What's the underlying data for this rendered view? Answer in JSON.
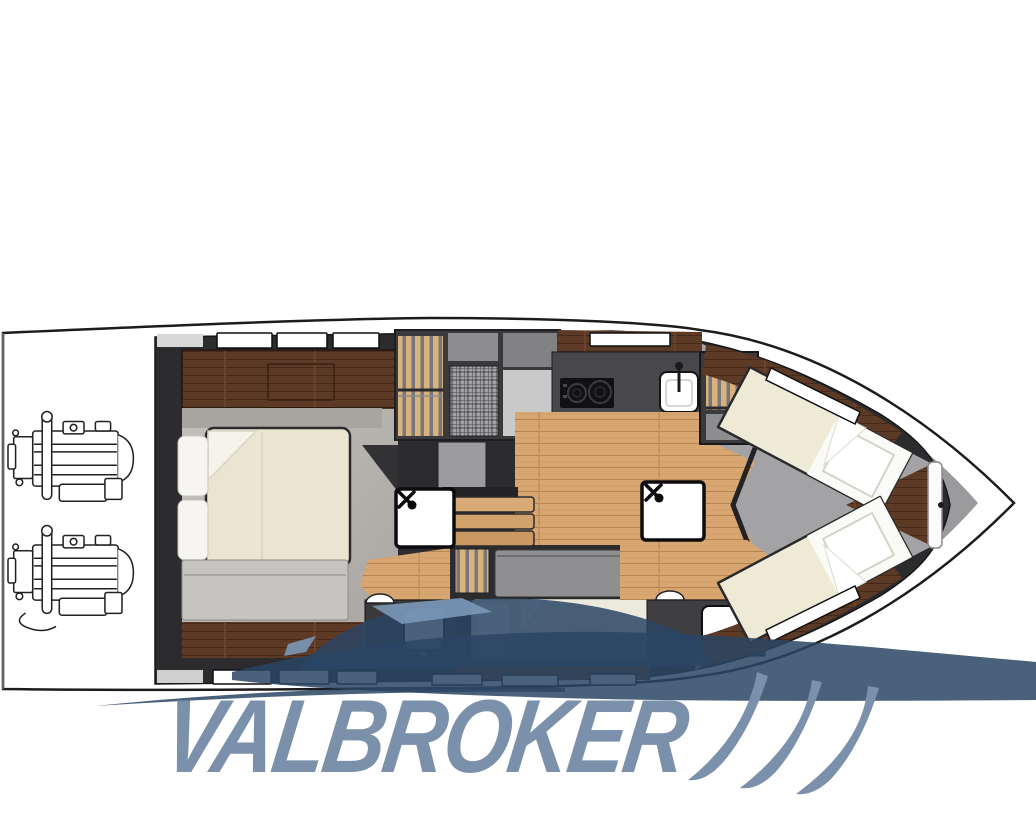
{
  "page": {
    "background": "#ffffff"
  },
  "brand": {
    "logo_text": "VALBROKER",
    "logo_color": "#7b91ab",
    "swoosh_color": "#7b91ab",
    "watermark_color": "#2a4564",
    "watermark_accent": "#7b98b8"
  },
  "floorplan": {
    "type": "motor-yacht-lower-deck-plan",
    "orientation": "bow-right",
    "colors": {
      "hull_outline": "#1c1c1e",
      "interior_walls": "#2c2c2e",
      "side_deck": "#9b9b9d",
      "oak_floor": "#d8a771",
      "walnut_wood": "#5d3a26",
      "cabin_floor": "#b4b1ac",
      "mattress": "#eae5d1",
      "linen": "#f7f6f2",
      "galley_counter": "#48484c",
      "cooktop": "#111113",
      "berth_gray": "#8f8f92",
      "wardrobe_stripe": "#d9b17a",
      "window": "#ffffff"
    },
    "areas": [
      {
        "name": "owner-cabin"
      },
      {
        "name": "saloon-galley"
      },
      {
        "name": "companionway-stairs"
      },
      {
        "name": "midship-bathroom"
      },
      {
        "name": "guest-cabin"
      },
      {
        "name": "forward-bathroom"
      },
      {
        "name": "bow-vip-cabin"
      },
      {
        "name": "engine-room"
      }
    ],
    "fixtures": [
      "cooktop-icon",
      "sink-icon",
      "shower-mixer-icon",
      "toilet-icon",
      "faucet-icon"
    ],
    "engines": {
      "count": 2
    }
  }
}
